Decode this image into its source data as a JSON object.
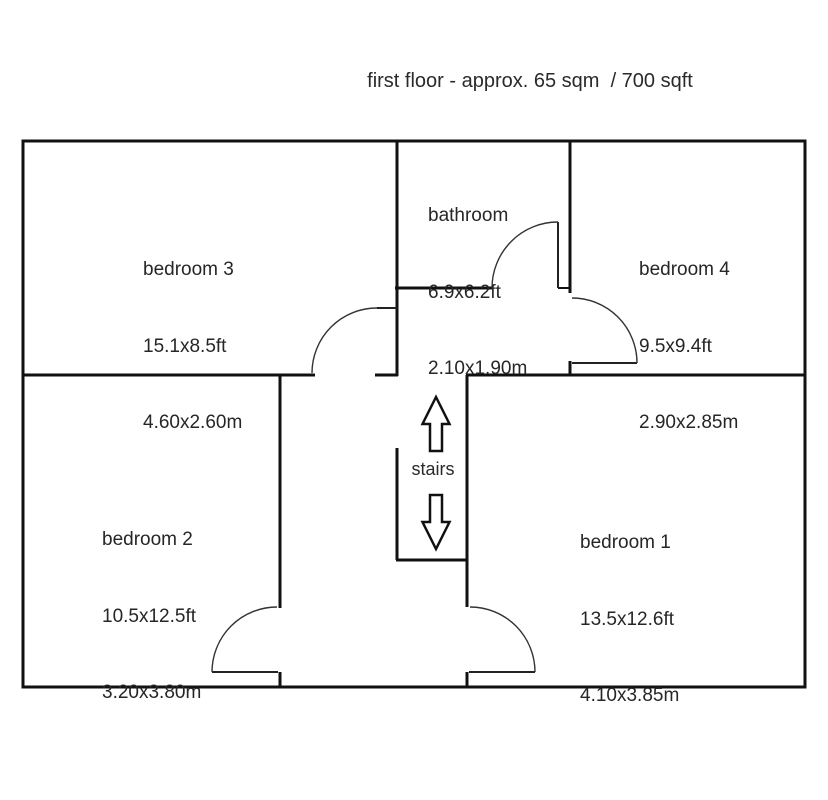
{
  "title": "first floor - approx. 65 sqm  / 700 sqft",
  "rooms": {
    "bedroom3": {
      "name": "bedroom 3",
      "dims_ft": "15.1x8.5ft",
      "dims_m": "4.60x2.60m"
    },
    "bathroom": {
      "name": "bathroom",
      "dims_ft": "6.9x6.2ft",
      "dims_m": "2.10x1.90m"
    },
    "bedroom4": {
      "name": "bedroom 4",
      "dims_ft": "9.5x9.4ft",
      "dims_m": "2.90x2.85m"
    },
    "bedroom2": {
      "name": "bedroom 2",
      "dims_ft": "10.5x12.5ft",
      "dims_m": "3.20x3.80m"
    },
    "bedroom1": {
      "name": "bedroom 1",
      "dims_ft": "13.5x12.6ft",
      "dims_m": "4.10x3.85m"
    }
  },
  "stairs": {
    "label": "stairs"
  },
  "colors": {
    "wall": "#111111",
    "text": "#262626",
    "background": "#ffffff"
  }
}
